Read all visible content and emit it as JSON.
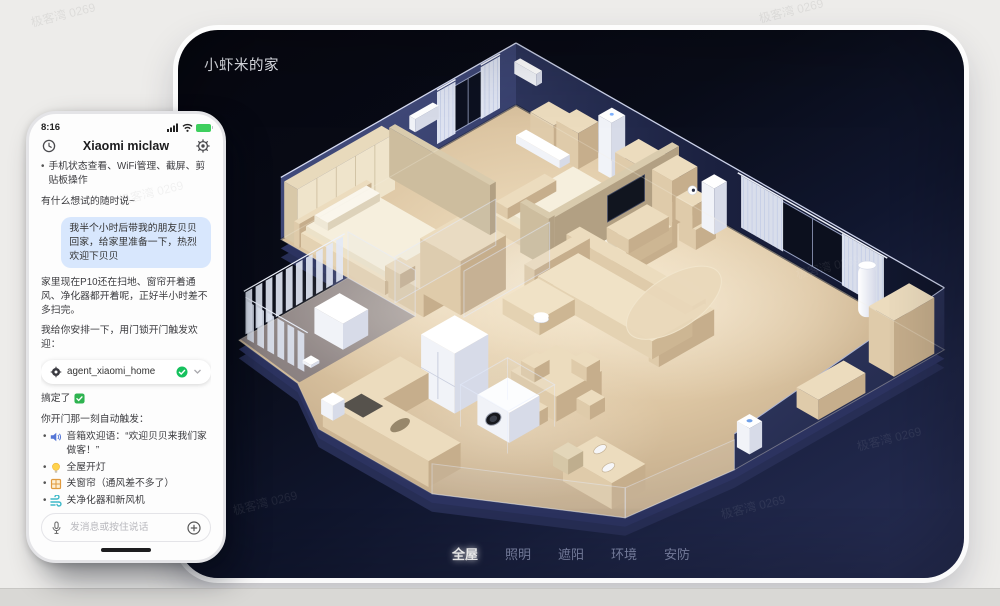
{
  "watermark": {
    "text": "极客湾 0269"
  },
  "home_view": {
    "title": "小虾米的家",
    "tabs": [
      {
        "label": "全屋",
        "active": true
      },
      {
        "label": "照明",
        "active": false
      },
      {
        "label": "遮阳",
        "active": false
      },
      {
        "label": "环境",
        "active": false
      },
      {
        "label": "安防",
        "active": false
      }
    ]
  },
  "phone": {
    "status_bar": {
      "time": "8:16"
    },
    "header": {
      "title": "Xiaomi miclaw"
    },
    "messages": {
      "capability_bullet": "手机状态查看、WiFi管理、截屏、剪贴板操作",
      "prompt_hint": "有什么想试的随时说~",
      "user_message": "我半个小时后带我的朋友贝贝回家，给家里准备一下，热烈欢迎下贝贝",
      "status_reply": "家里现在P10还在扫地、窗帘开着通风、净化器都开着呢，正好半小时差不多扫完。",
      "plan_intro": "我给你安排一下，用门锁开门触发欢迎：",
      "agent_pill": {
        "name": "agent_xiaomi_home"
      },
      "done_text": "搞定了",
      "trigger_intro": "你开门那一刻自动触发：",
      "triggers": [
        {
          "icon": "speaker-icon",
          "text": "音箱欢迎语：“欢迎贝贝来我们家做客！”"
        },
        {
          "icon": "bulb-icon",
          "text": "全屋开灯"
        },
        {
          "icon": "window-icon",
          "text": "关窗帘（通风差不多了）"
        },
        {
          "icon": "wind-icon",
          "text": "关净化器和新风机"
        },
        {
          "icon": "music-icon",
          "text": "放欢快音乐"
        }
      ],
      "closing_pre": "家里没人，音量不客气，排面给足",
      "closing_post": "贝贝一进门就有仪式感！"
    },
    "input": {
      "placeholder": "发消息或按住说话"
    }
  },
  "colors": {
    "bubble_blue": "#d8e7fd",
    "check_green": "#2eb350",
    "battery_green": "#3ecf5e",
    "floor_beige": "#dbc4a1",
    "panel_navy": "#272e55"
  }
}
